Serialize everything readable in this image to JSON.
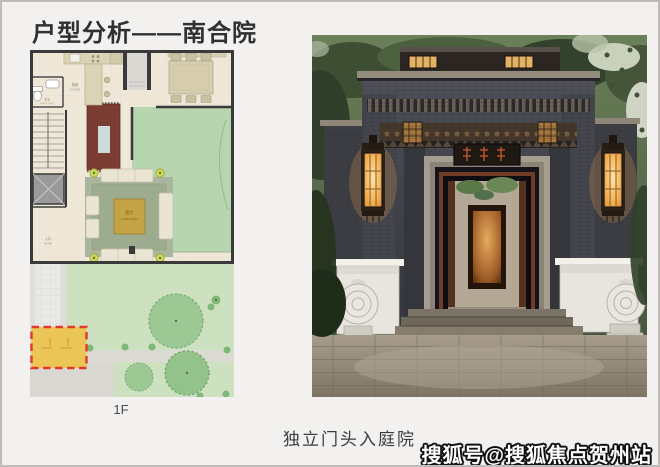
{
  "slide": {
    "title": "户型分析——南合院",
    "floor_label": "1F",
    "caption": "独立门头入庭院",
    "watermark": "搜狐号@搜狐焦点贺州站"
  },
  "floor_plan": {
    "labels": {
      "kitchen": "厨房",
      "kitchen_en": "KITCHEN",
      "guest_toilet": "客卫",
      "guest_toilet_en": "GUEST TOILET",
      "foyer": "入口",
      "foyer_en": "FOYER",
      "living": "客厅",
      "living_en": "LIVING ROOM"
    },
    "highlight": {
      "fill": "#ebc657",
      "border": "#e23a28"
    }
  },
  "photo": {
    "subject": "独立门头：深灰砖砌门楼、暖色壁灯、抱鼓石与庭院廊道"
  },
  "colors": {
    "page_background": "#f2f1ef",
    "title_text": "#303030",
    "caption_text": "#3c3c3c",
    "watermark_fill": "#ffffff",
    "watermark_outline": "#111111",
    "lawn_green": "#cde1c1",
    "lantern_glow": "#f3b152"
  }
}
